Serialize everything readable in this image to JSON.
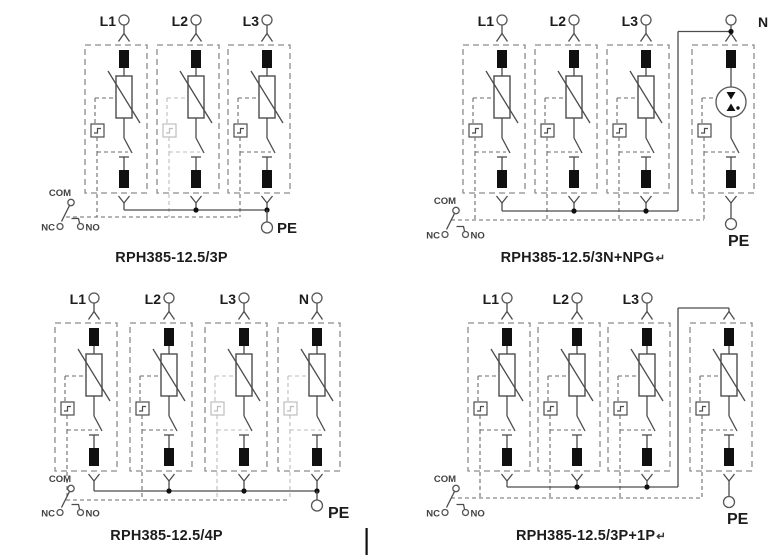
{
  "colors": {
    "background": "#ffffff",
    "line": "#4c4c4c",
    "dashed_box": "#8c8c8c",
    "linkage": "#6b6b6b",
    "faded": "#bdbdbd",
    "terminal_black": "#101010",
    "text": "#1c1c1c",
    "switch_text": "#424242"
  },
  "diagrams": [
    {
      "id": "rph385-12-5-3p",
      "title": "RPH385-12.5/3P",
      "title_suffix": "",
      "pe_label": "PE",
      "switch_labels": {
        "com": "COM",
        "nc": "NC",
        "no": "NO"
      },
      "modules": [
        {
          "top_label": "L1",
          "label_side": "left",
          "element": "varistor",
          "indicator": "normal"
        },
        {
          "top_label": "L2",
          "label_side": "left",
          "element": "varistor",
          "indicator": "faded"
        },
        {
          "top_label": "L3",
          "label_side": "left",
          "element": "varistor",
          "indicator": "normal"
        }
      ],
      "layout": {
        "title_x": 172,
        "module_lefts": [
          85,
          157,
          228
        ],
        "bus_y": 210,
        "rail_y": 217,
        "bus_dots": [
          1,
          2
        ],
        "switch_dy": 0,
        "pe": {
          "mode": "bus_drop",
          "module": 2,
          "label_dx": 10,
          "label_y": 233,
          "size": 15
        },
        "top_feed": null,
        "artifact_bar": null
      }
    },
    {
      "id": "rph385-12-5-3n-npg",
      "title": "RPH385-12.5/3N+NPG",
      "title_suffix": "↵",
      "pe_label": "PE",
      "switch_labels": {
        "com": "COM",
        "nc": "NC",
        "no": "NO"
      },
      "modules": [
        {
          "top_label": "L1",
          "label_side": "left",
          "element": "varistor",
          "indicator": "normal"
        },
        {
          "top_label": "L2",
          "label_side": "left",
          "element": "varistor",
          "indicator": "normal"
        },
        {
          "top_label": "L3",
          "label_side": "left",
          "element": "varistor",
          "indicator": "normal"
        },
        {
          "top_label": "N",
          "label_side": "right",
          "element": "gdt",
          "indicator": "normal"
        }
      ],
      "layout": {
        "title_x": 198,
        "module_lefts": [
          78,
          150,
          222,
          307
        ],
        "bus_y": 211,
        "rail_y": 220,
        "bus_dots": [
          1,
          2
        ],
        "switch_dy": 8,
        "pe": {
          "mode": "below_module",
          "module": 3,
          "label_dx": -3,
          "label_y": 246,
          "size": 16
        },
        "top_feed": {
          "riser_x": 293,
          "wire_y": 31.5,
          "to_module": 3,
          "join": "dot"
        },
        "artifact_bar": null
      }
    },
    {
      "id": "rph385-12-5-4p",
      "title": "RPH385-12.5/4P",
      "title_suffix": "",
      "pe_label": "PE",
      "switch_labels": {
        "com": "COM",
        "nc": "NC",
        "no": "NO"
      },
      "modules": [
        {
          "top_label": "L1",
          "label_side": "left",
          "element": "varistor",
          "indicator": "normal"
        },
        {
          "top_label": "L2",
          "label_side": "left",
          "element": "varistor",
          "indicator": "normal"
        },
        {
          "top_label": "L3",
          "label_side": "left",
          "element": "varistor",
          "indicator": "faded"
        },
        {
          "top_label": "N",
          "label_side": "left",
          "element": "varistor",
          "indicator": "faded"
        }
      ],
      "layout": {
        "title_x": 167,
        "module_lefts": [
          55,
          130,
          205,
          278
        ],
        "bus_y": 213,
        "rail_y": 222,
        "bus_dots": [
          1,
          2,
          3
        ],
        "switch_dy": 8,
        "pe": {
          "mode": "bus_drop",
          "module": 3,
          "label_dx": 11,
          "label_y": 240,
          "size": 16
        },
        "top_feed": null,
        "artifact_bar": {
          "x": 365.5,
          "y": 250,
          "h": 27
        }
      }
    },
    {
      "id": "rph385-12-5-3p-1p",
      "title": "RPH385-12.5/3P+1P",
      "title_suffix": "↵",
      "pe_label": "PE",
      "switch_labels": {
        "com": "COM",
        "nc": "NC",
        "no": "NO"
      },
      "modules": [
        {
          "top_label": "L1",
          "label_side": "left",
          "element": "varistor",
          "indicator": "normal"
        },
        {
          "top_label": "L2",
          "label_side": "left",
          "element": "varistor",
          "indicator": "normal"
        },
        {
          "top_label": "L3",
          "label_side": "left",
          "element": "varistor",
          "indicator": "normal"
        },
        {
          "top_label": null,
          "label_side": "left",
          "element": "varistor",
          "indicator": "normal"
        }
      ],
      "layout": {
        "title_x": 206,
        "module_lefts": [
          83,
          153,
          223,
          305
        ],
        "bus_y": 209,
        "rail_y": 220,
        "bus_dots": [
          1,
          2
        ],
        "switch_dy": 8,
        "pe": {
          "mode": "below_module",
          "module": 3,
          "label_dx": -2,
          "label_y": 246,
          "size": 16
        },
        "top_feed": {
          "riser_x": 293,
          "wire_y": 30,
          "to_module": 3,
          "join": "top"
        },
        "artifact_bar": null
      }
    }
  ]
}
